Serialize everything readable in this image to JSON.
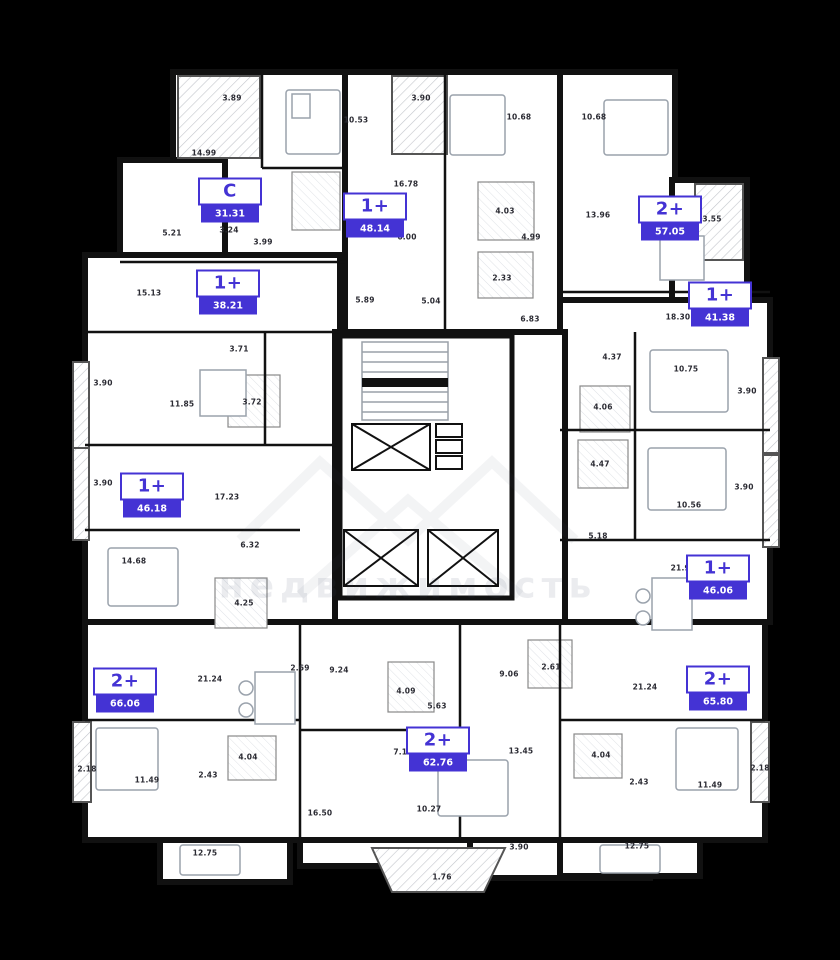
{
  "plan": {
    "accent_color": "#4433d4",
    "wall_color": "#111111",
    "background_color": "#000000",
    "floor_fill": "#ffffff"
  },
  "watermark": {
    "text": "недвижимость"
  },
  "units": [
    {
      "type_label": "C",
      "area": "31.31",
      "x": 230,
      "y": 200
    },
    {
      "type_label": "1+",
      "area": "48.14",
      "x": 375,
      "y": 215
    },
    {
      "type_label": "2+",
      "area": "57.05",
      "x": 670,
      "y": 218
    },
    {
      "type_label": "1+",
      "area": "38.21",
      "x": 228,
      "y": 292
    },
    {
      "type_label": "1+",
      "area": "41.38",
      "x": 720,
      "y": 304
    },
    {
      "type_label": "1+",
      "area": "46.18",
      "x": 152,
      "y": 495
    },
    {
      "type_label": "1+",
      "area": "46.06",
      "x": 718,
      "y": 577
    },
    {
      "type_label": "2+",
      "area": "66.06",
      "x": 125,
      "y": 690
    },
    {
      "type_label": "2+",
      "area": "65.80",
      "x": 718,
      "y": 688
    },
    {
      "type_label": "2+",
      "area": "62.76",
      "x": 438,
      "y": 749
    }
  ],
  "dimensions": [
    {
      "value": "3.89",
      "x": 232,
      "y": 98
    },
    {
      "value": "10.53",
      "x": 356,
      "y": 120
    },
    {
      "value": "3.90",
      "x": 421,
      "y": 98
    },
    {
      "value": "10.68",
      "x": 519,
      "y": 117
    },
    {
      "value": "10.68",
      "x": 594,
      "y": 117
    },
    {
      "value": "14.99",
      "x": 204,
      "y": 153
    },
    {
      "value": "16.78",
      "x": 406,
      "y": 184
    },
    {
      "value": "13.96",
      "x": 598,
      "y": 215
    },
    {
      "value": "3.55",
      "x": 712,
      "y": 219
    },
    {
      "value": "4.03",
      "x": 505,
      "y": 211
    },
    {
      "value": "5.21",
      "x": 172,
      "y": 233
    },
    {
      "value": "3.24",
      "x": 229,
      "y": 230
    },
    {
      "value": "3.99",
      "x": 263,
      "y": 242
    },
    {
      "value": "6.00",
      "x": 407,
      "y": 237
    },
    {
      "value": "4.99",
      "x": 531,
      "y": 237
    },
    {
      "value": "2.33",
      "x": 502,
      "y": 278
    },
    {
      "value": "15.13",
      "x": 149,
      "y": 293
    },
    {
      "value": "5.89",
      "x": 365,
      "y": 300
    },
    {
      "value": "5.04",
      "x": 431,
      "y": 301
    },
    {
      "value": "6.83",
      "x": 530,
      "y": 319
    },
    {
      "value": "18.30",
      "x": 678,
      "y": 317
    },
    {
      "value": "3.71",
      "x": 239,
      "y": 349
    },
    {
      "value": "4.37",
      "x": 612,
      "y": 357
    },
    {
      "value": "10.75",
      "x": 686,
      "y": 369
    },
    {
      "value": "3.90",
      "x": 103,
      "y": 383
    },
    {
      "value": "3.90",
      "x": 747,
      "y": 391
    },
    {
      "value": "11.85",
      "x": 182,
      "y": 404
    },
    {
      "value": "3.72",
      "x": 252,
      "y": 402
    },
    {
      "value": "4.06",
      "x": 603,
      "y": 407
    },
    {
      "value": "4.47",
      "x": 600,
      "y": 464
    },
    {
      "value": "3.90",
      "x": 103,
      "y": 483
    },
    {
      "value": "3.90",
      "x": 744,
      "y": 487
    },
    {
      "value": "17.23",
      "x": 227,
      "y": 497
    },
    {
      "value": "10.56",
      "x": 689,
      "y": 505
    },
    {
      "value": "5.18",
      "x": 598,
      "y": 536
    },
    {
      "value": "6.32",
      "x": 250,
      "y": 545
    },
    {
      "value": "14.68",
      "x": 134,
      "y": 561
    },
    {
      "value": "21.95",
      "x": 683,
      "y": 568
    },
    {
      "value": "4.25",
      "x": 244,
      "y": 603
    },
    {
      "value": "2.69",
      "x": 300,
      "y": 668
    },
    {
      "value": "9.24",
      "x": 339,
      "y": 670
    },
    {
      "value": "2.61",
      "x": 551,
      "y": 667
    },
    {
      "value": "9.06",
      "x": 509,
      "y": 674
    },
    {
      "value": "21.24",
      "x": 210,
      "y": 679
    },
    {
      "value": "4.09",
      "x": 406,
      "y": 691
    },
    {
      "value": "21.24",
      "x": 645,
      "y": 687
    },
    {
      "value": "5.63",
      "x": 437,
      "y": 706
    },
    {
      "value": "7.16",
      "x": 403,
      "y": 752
    },
    {
      "value": "13.45",
      "x": 521,
      "y": 751
    },
    {
      "value": "4.04",
      "x": 248,
      "y": 757
    },
    {
      "value": "4.04",
      "x": 601,
      "y": 755
    },
    {
      "value": "2.18",
      "x": 87,
      "y": 769
    },
    {
      "value": "2.43",
      "x": 208,
      "y": 775
    },
    {
      "value": "2.43",
      "x": 639,
      "y": 782
    },
    {
      "value": "11.49",
      "x": 147,
      "y": 780
    },
    {
      "value": "11.49",
      "x": 710,
      "y": 785
    },
    {
      "value": "2.18",
      "x": 760,
      "y": 768
    },
    {
      "value": "16.50",
      "x": 320,
      "y": 813
    },
    {
      "value": "10.27",
      "x": 429,
      "y": 809
    },
    {
      "value": "12.75",
      "x": 205,
      "y": 853
    },
    {
      "value": "3.90",
      "x": 519,
      "y": 847
    },
    {
      "value": "12.75",
      "x": 637,
      "y": 846
    },
    {
      "value": "1.76",
      "x": 442,
      "y": 877
    }
  ]
}
